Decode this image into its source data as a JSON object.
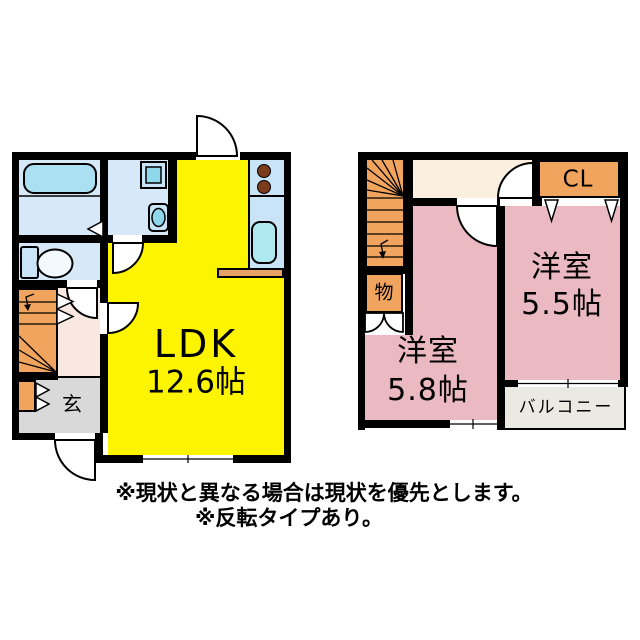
{
  "floor1": {
    "ldk": {
      "name": "LDK",
      "size": "12.6帖"
    },
    "genkan": {
      "label": "玄"
    }
  },
  "floor2": {
    "room_58": {
      "name": "洋室",
      "size": "5.8帖"
    },
    "room_55": {
      "name": "洋室",
      "size": "5.5帖"
    },
    "closet": {
      "label": "CL"
    },
    "storage": {
      "label": "物"
    },
    "balcony": {
      "label": "バルコニー"
    }
  },
  "notes": {
    "line1": "※現状と異なる場合は現状を優先とします。",
    "line2": "※反転タイプあり。"
  },
  "icons": [
    "bathtub-icon",
    "washing-machine-icon",
    "washbasin-icon",
    "toilet-icon",
    "stove-burners-icon",
    "kitchen-sink-icon",
    "stairs-icon",
    "door-swing-icon",
    "window-icon",
    "folding-door-icon",
    "closet-door-icon"
  ],
  "colors": {
    "ldk": "#FCF400",
    "western_room": "#EBB9C1",
    "wet_area": "#D7E9F8",
    "stairs_storage_closet": "#F1A45D",
    "hallway_1f": "#F9E8E0",
    "hallway_2f": "#FBEFDF",
    "genkan": "#D9D9D9",
    "balcony": "#EAEAE2",
    "counter": "#E8A266",
    "wall": "#000000"
  }
}
